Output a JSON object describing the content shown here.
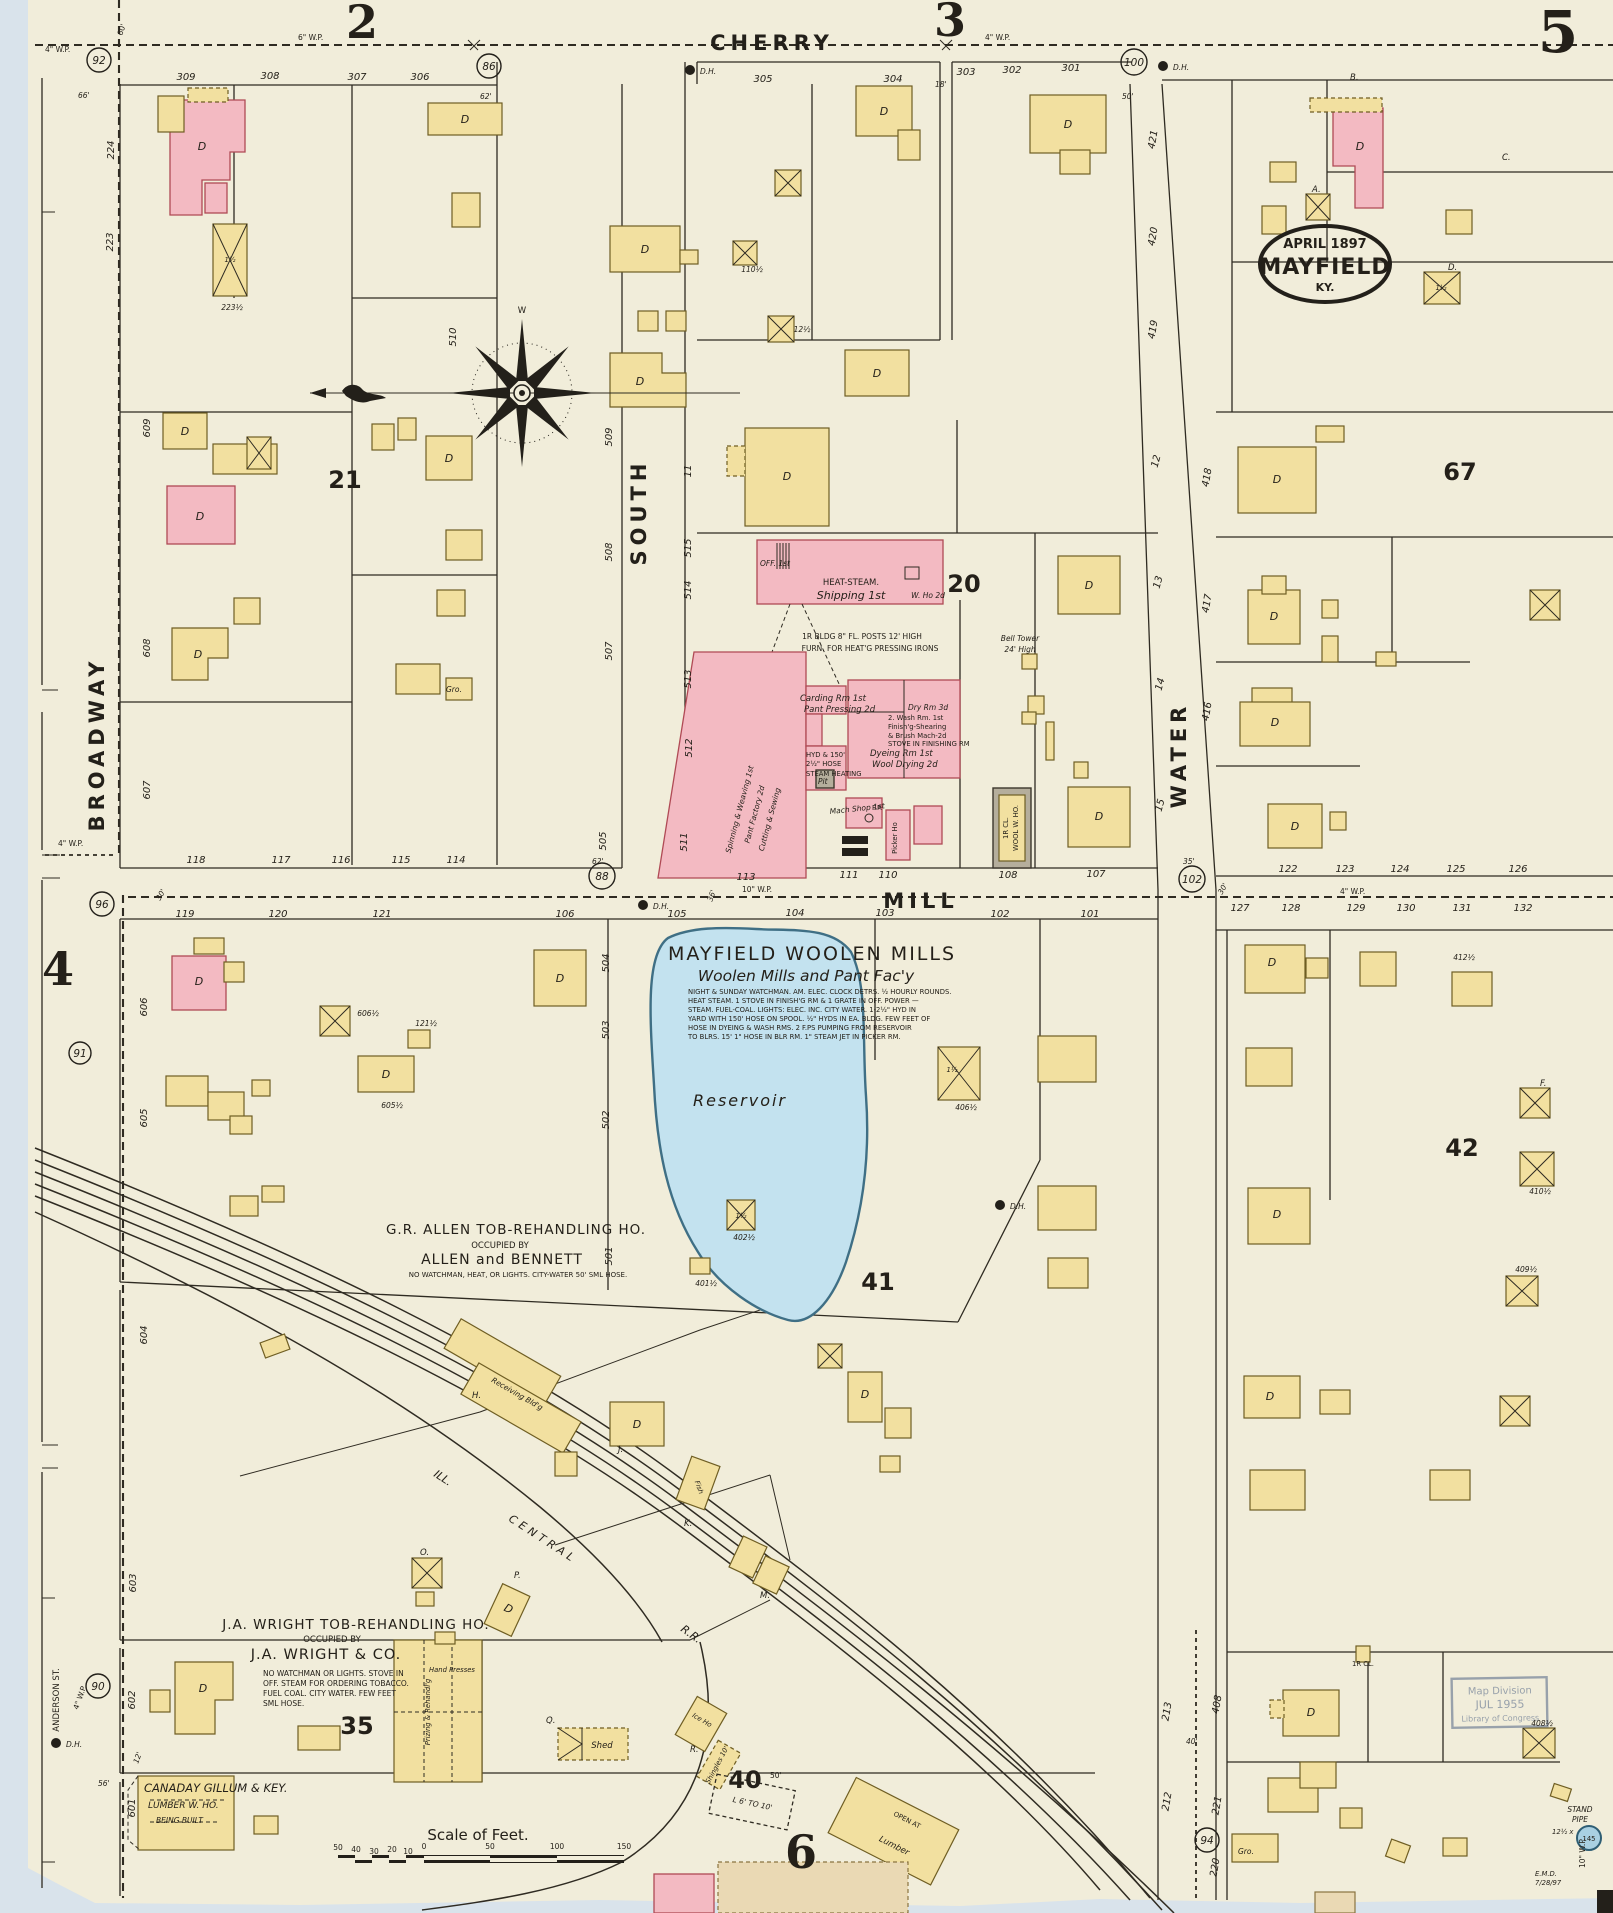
{
  "page_refs": {
    "tl": "2",
    "tm": "3",
    "tr": "5",
    "left": "4",
    "bottom": "6"
  },
  "title_oval": {
    "l1": "APRIL 1897",
    "l2": "MAYFIELD",
    "l3": "KY."
  },
  "streets": {
    "cherry": "CHERRY",
    "mill": "MILL",
    "south": "SOUTH",
    "water": "WATER",
    "broadway": "BROADWAY",
    "anderson": "ANDERSON ST."
  },
  "railroad": {
    "ill": "ILL.",
    "central": "CENTRAL",
    "rr": "R.R."
  },
  "blocks": {
    "b20": "20",
    "b21": "21",
    "b35": "35",
    "b40": "40",
    "b41": "41",
    "b42": "42",
    "b67": "67"
  },
  "circles": {
    "c92": "92",
    "c86": "86",
    "c100": "100",
    "c96": "96",
    "c91": "91",
    "c88": "88",
    "c102": "102",
    "c90": "90",
    "c94": "94"
  },
  "wp": {
    "w4": "4\" W.P.",
    "w6": "6\" W.P.",
    "w10": "10\" W.P."
  },
  "dh": "D.H.",
  "dims": {
    "d60": "60'",
    "d66": "66'",
    "d62": "62'",
    "d18": "18'",
    "d50": "50'",
    "d35": "35'",
    "d30": "30'",
    "d36": "36'",
    "d40": "40'",
    "d56": "56'",
    "d12": "12'",
    "d10": "10'",
    "d15": "15'"
  },
  "lots": {
    "cherry": [
      "309",
      "308",
      "307",
      "306",
      "305",
      "304",
      "303",
      "302",
      "301"
    ],
    "mill_north": [
      "118",
      "117",
      "116",
      "115",
      "114",
      "113",
      "111",
      "110",
      "108",
      "107"
    ],
    "mill_north_right": [
      "122",
      "123",
      "124",
      "125",
      "126"
    ],
    "mill_south": [
      "119",
      "120",
      "121",
      "106",
      "105",
      "104",
      "103",
      "102",
      "101"
    ],
    "mill_south_right": [
      "127",
      "128",
      "129",
      "130",
      "131",
      "132"
    ],
    "left_col": [
      "224",
      "223",
      "609",
      "608",
      "607",
      "606",
      "605",
      "604",
      "603",
      "602",
      "601"
    ],
    "south_west": [
      "510",
      "509",
      "508",
      "507",
      "505",
      "504",
      "503",
      "502",
      "501"
    ],
    "south_east": [
      "515",
      "514",
      "513",
      "512",
      "511",
      "11"
    ],
    "water_west": [
      "12",
      "13",
      "14",
      "15"
    ],
    "water_east": [
      "421",
      "420",
      "419",
      "418",
      "417",
      "416"
    ],
    "right_edge": [
      "213",
      "212",
      "408",
      "221",
      "220"
    ]
  },
  "halfs": {
    "h223": "223½",
    "h110": "110½",
    "h12": "12½",
    "h606": "606½",
    "h605": "605½",
    "h121": "121½",
    "h406": "406½",
    "h402": "402½",
    "h401": "401½",
    "h412": "412½",
    "h410": "410½",
    "h409": "409½",
    "h408": "408½",
    "h1": "1½",
    "h2": "2"
  },
  "woolen_mills": {
    "title": "MAYFIELD WOOLEN MILLS",
    "subtitle": "Woolen Mills and Pant Fac'y",
    "notes": [
      "NIGHT & SUNDAY WATCHMAN. AM. ELEC. CLOCK DETRS. ½ HOURLY ROUNDS.",
      "HEAT STEAM. 1 STOVE IN FINISH'G RM & 1 GRATE IN OFF.  POWER —",
      "STEAM. FUEL-COAL. LIGHTS: ELEC. INC. CITY WATER. 1-2½\" HYD IN",
      "YARD WITH 150' HOSE ON SPOOL. ½\" HYDS IN EA. BLDG. FEW FEET OF",
      "HOSE IN DYEING & WASH RMS.  2 F.PS PUMPING FROM RESERVOIR",
      "TO BLRS. 15' 1\" HOSE IN BLR RM. 1\" STEAM JET IN PICKER RM."
    ]
  },
  "factory": {
    "off": "OFF. 1st",
    "heat": "HEAT-STEAM.",
    "shipping": "Shipping 1st",
    "who": "W. Ho 2d",
    "carding": "Carding Rm 1st",
    "pant": "Pant Pressing 2d",
    "dry": "Dry Rm 3d",
    "wash1": "2. Wash Rm. 1st",
    "wash2": "Finish'g-Shearing",
    "wash3": "& Brush Mach-2d",
    "wash4": "STOVE IN FINISHING RM",
    "dye1": "Dyeing Rm 1st",
    "dye2": "Wool Drying 2d",
    "hyd1": "HYD & 150'",
    "hyd2": "2½\" HOSE",
    "heat2": "STEAM HEATING",
    "pit": "Pit",
    "mach": "Mach Shop 1st",
    "fp": "F.P.",
    "spin1": "Spinning & Weaving 1st",
    "spin2": "Pant Factory 2d",
    "spin3": "Cutting & Sewing",
    "posts1": "1R BLDG 8\" FL. POSTS 12' HIGH",
    "posts2": "FURN. FOR HEAT'G PRESSING IRONS",
    "bell1": "Bell Tower",
    "bell2": "24' High",
    "picker": "Picker Ho",
    "woolwho1": "1R CL.",
    "woolwho2": "WOOL W. HO."
  },
  "allen": {
    "title": "G.R. ALLEN TOB-REHANDLING HO.",
    "occupied": "OCCUPIED BY",
    "name": "ALLEN and BENNETT",
    "note": "NO WATCHMAN, HEAT, OR LIGHTS. CITY-WATER 50' SML HOSE."
  },
  "wright": {
    "title": "J.A. WRIGHT TOB-REHANDLING HO.",
    "occupied": "OCCUPIED BY",
    "name": "J.A. WRIGHT & CO.",
    "notes": [
      "NO WATCHMAN OR LIGHTS. STOVE IN",
      "OFF. STEAM FOR ORDERING TOBACCO.",
      "FUEL COAL. CITY WATER. FEW FEET",
      "SML HOSE."
    ]
  },
  "canaday": {
    "name": "CANADAY GILLUM & KEY.",
    "line2": "LUMBER W. HO.",
    "line3": "BEING BUILT"
  },
  "scale": {
    "title": "Scale of Feet.",
    "ticks": [
      "50",
      "40",
      "30",
      "20",
      "10",
      "0",
      "50",
      "100",
      "150"
    ]
  },
  "reservoir_label": "Reservoir",
  "letters": {
    "A": "A.",
    "B": "B.",
    "C": "C.",
    "D": "D.",
    "O": "O.",
    "P": "P.",
    "Q": "Q.",
    "R": "R.",
    "J": "J.",
    "K": "K.",
    "M": "M.",
    "H": "H.",
    "F": "F."
  },
  "marks": {
    "d": "D",
    "gro": "Gro.",
    "fish": "Fish",
    "one_half": "1½",
    "two": "2",
    "one": "1",
    "x": "x"
  },
  "bldg_labels": {
    "shed": "Shed",
    "ice": "Ice Ho",
    "shingles": "Shingles 10'",
    "lumber": "Lumber",
    "open": "OPEN AT",
    "l610": "L 6' TO 10'",
    "cl": "1R CL.",
    "hand": "Hand Presses",
    "prizing": "Prizing & Rehandl'g",
    "receiving": "Receiving Bld'g"
  },
  "loc_stamp": {
    "l1": "Map Division",
    "l2": "JUL 1955",
    "l3": "Library of Congress"
  },
  "standpipe": {
    "l1": "STAND",
    "l2": "PIPE",
    "dim": "12½ x",
    "num": "145"
  },
  "emd": {
    "l1": "E.M.D.",
    "l2": "7/28/97"
  },
  "compass": {
    "top": "W"
  }
}
